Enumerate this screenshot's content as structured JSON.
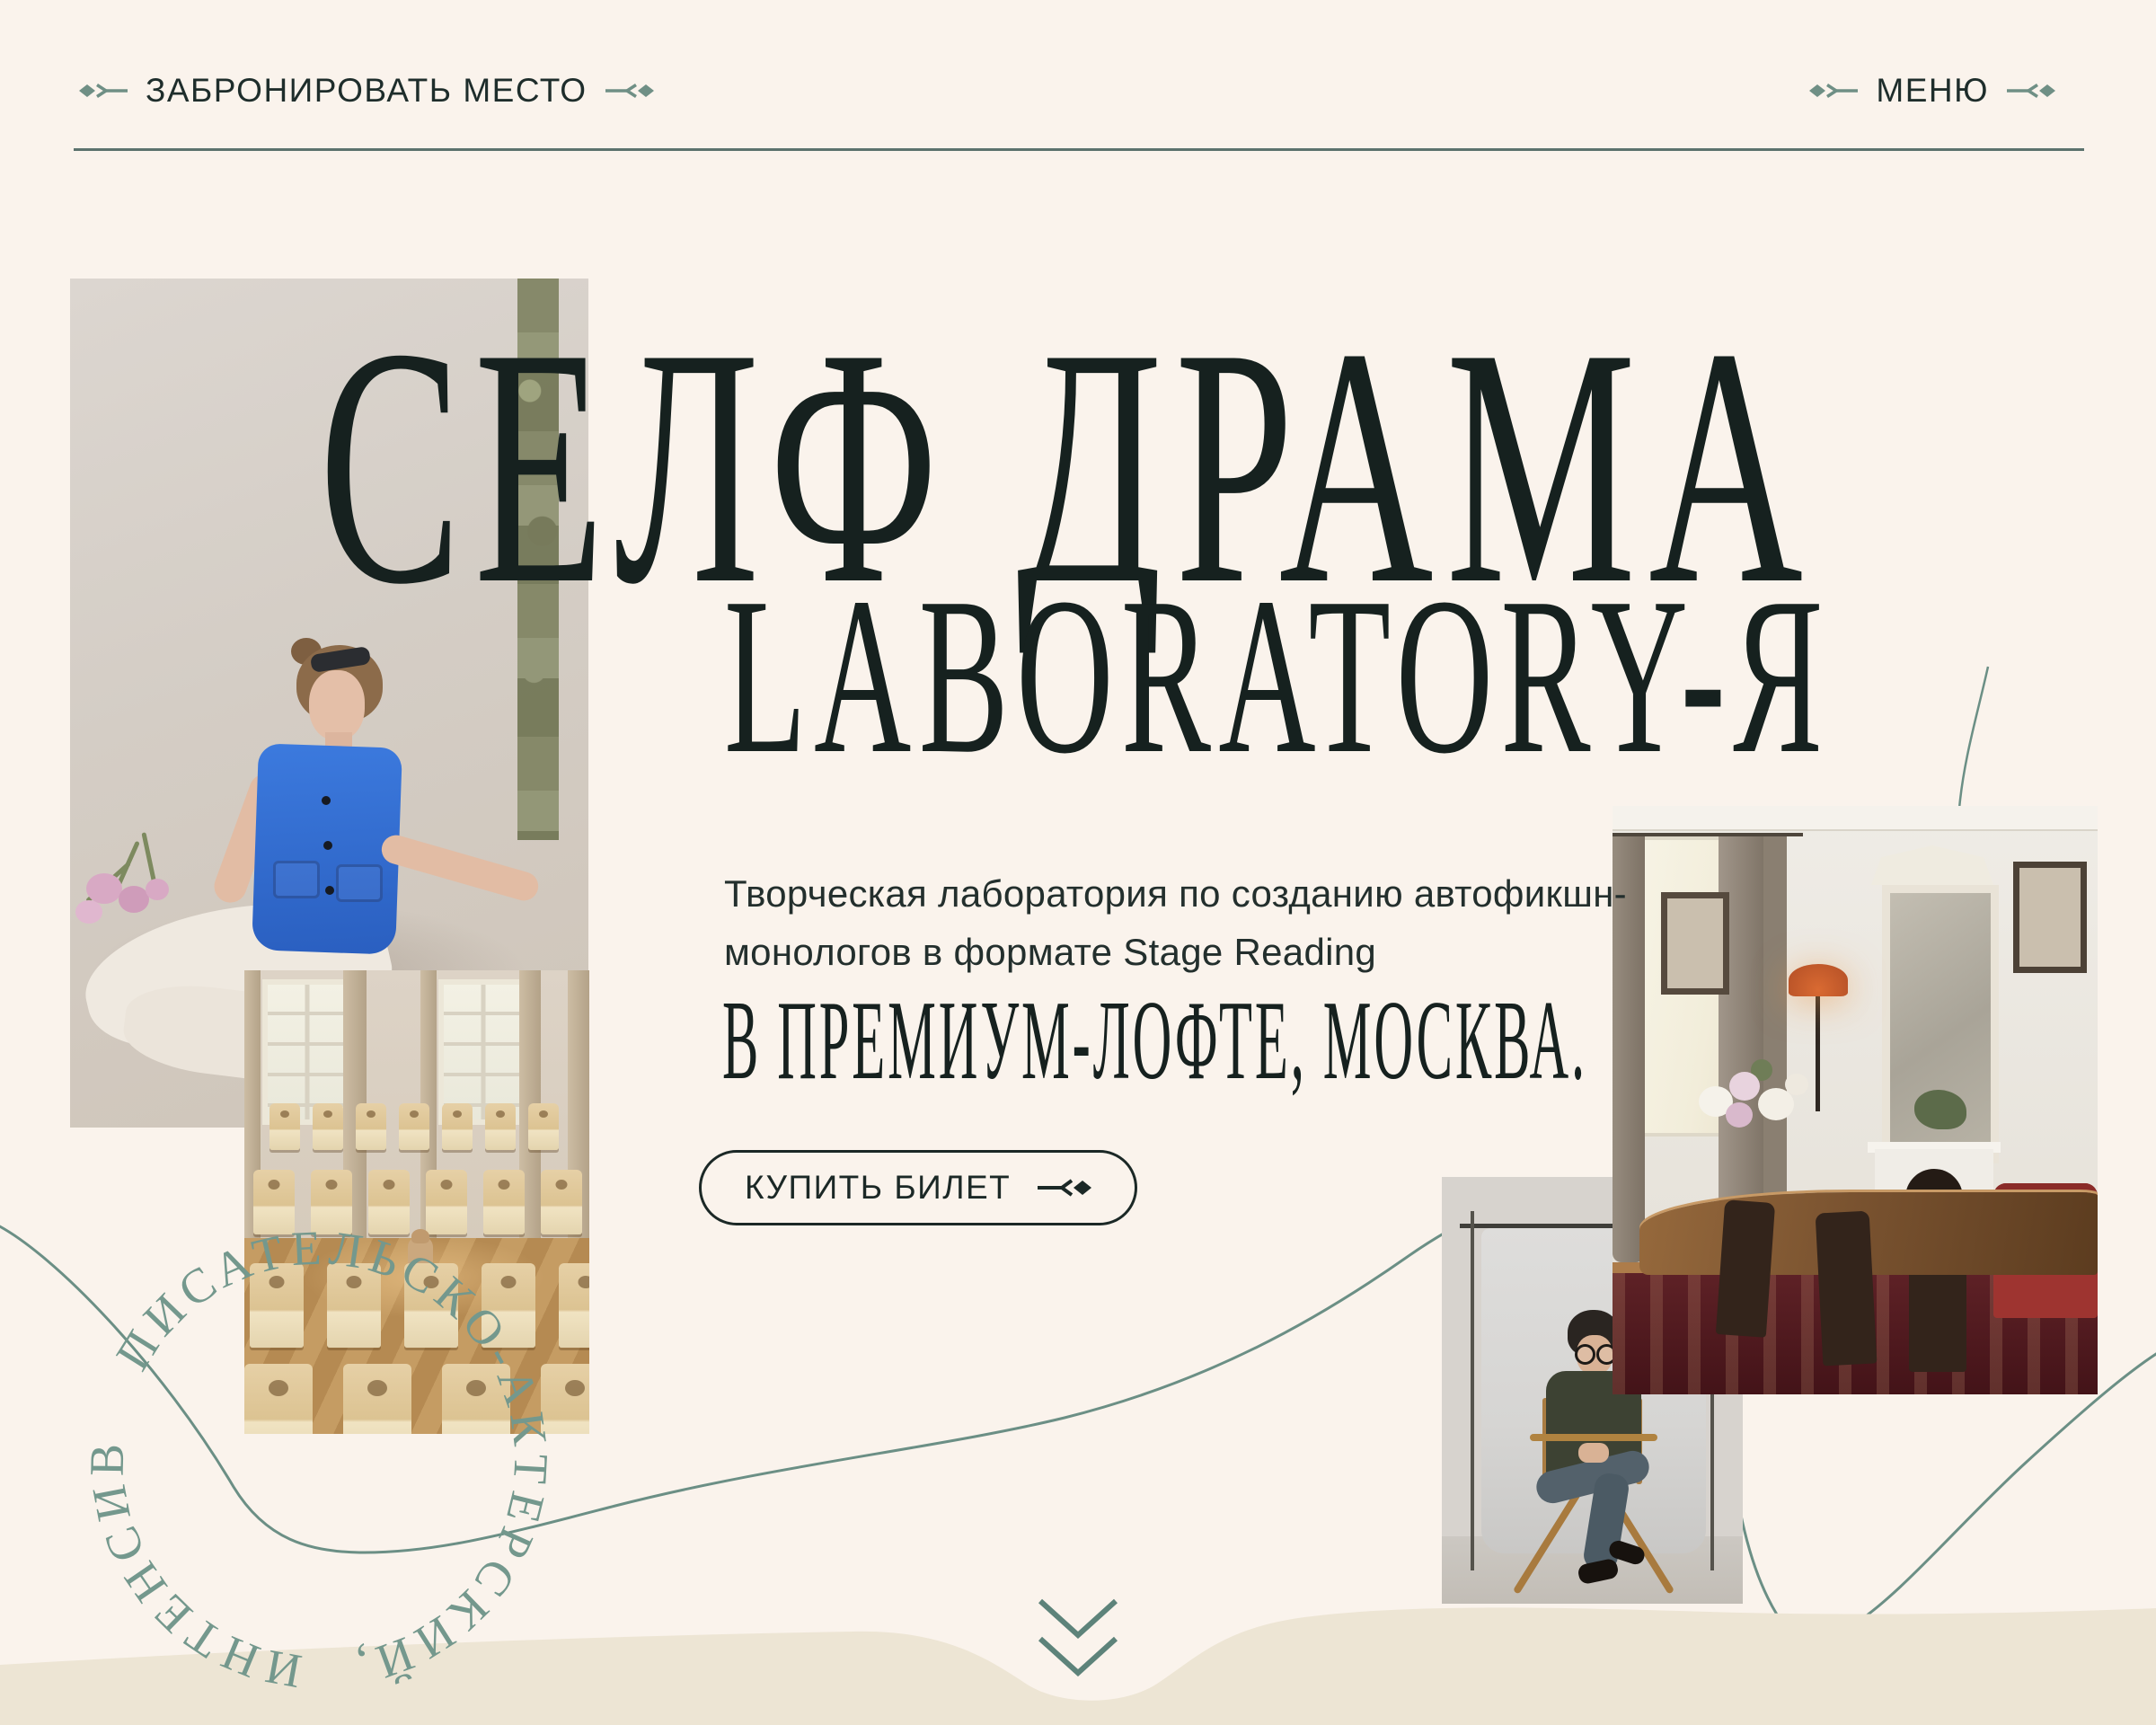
{
  "page": {
    "background_color": "#FAF3EC",
    "wave_fill_color": "#EDE5D4",
    "ink_color": "#1B2826",
    "teal_accent_color": "#6B8F85",
    "sage_text_color": "#74988D",
    "divider_color": "#5B726D"
  },
  "nav": {
    "book_label": "ЗАБРОНИРОВАТЬ МЕСТО",
    "menu_label": "МЕНЮ"
  },
  "hero": {
    "title_line_1": "СЕЛФ ДРАМА",
    "title_line_2": "LABORATORY-Я",
    "description_line_1": "Творческая лаборатория по созданию автофикшн-",
    "description_line_2": "монологов в формате Stage Reading",
    "location_line": "В ПРЕМИУМ-ЛОФТЕ, МОСКВА.",
    "cta_label": "КУПИТЬ БИЛЕТ"
  },
  "ring": {
    "text": "ПИСАТЕЛЬСКО-АКТЕРСКИЙ, ИНТЕНСИВ"
  },
  "photos": {
    "photo_1": "woman-in-blue-vest-studio-portrait",
    "photo_2": "loft-hall-with-rows-of-wooden-chairs-and-dog",
    "photo_3": "man-in-directors-chair-on-photo-backdrop",
    "photo_4": "classic-loft-interior-with-mirror-fireplace-and-table"
  },
  "icons": {
    "nav_left_decor": "diamond-arrow-right-icon",
    "nav_right_decor": "arrow-left-diamond-icon",
    "cta_icon": "arrow-diamond-icon",
    "scroll_icon": "double-chevron-down-icon"
  }
}
